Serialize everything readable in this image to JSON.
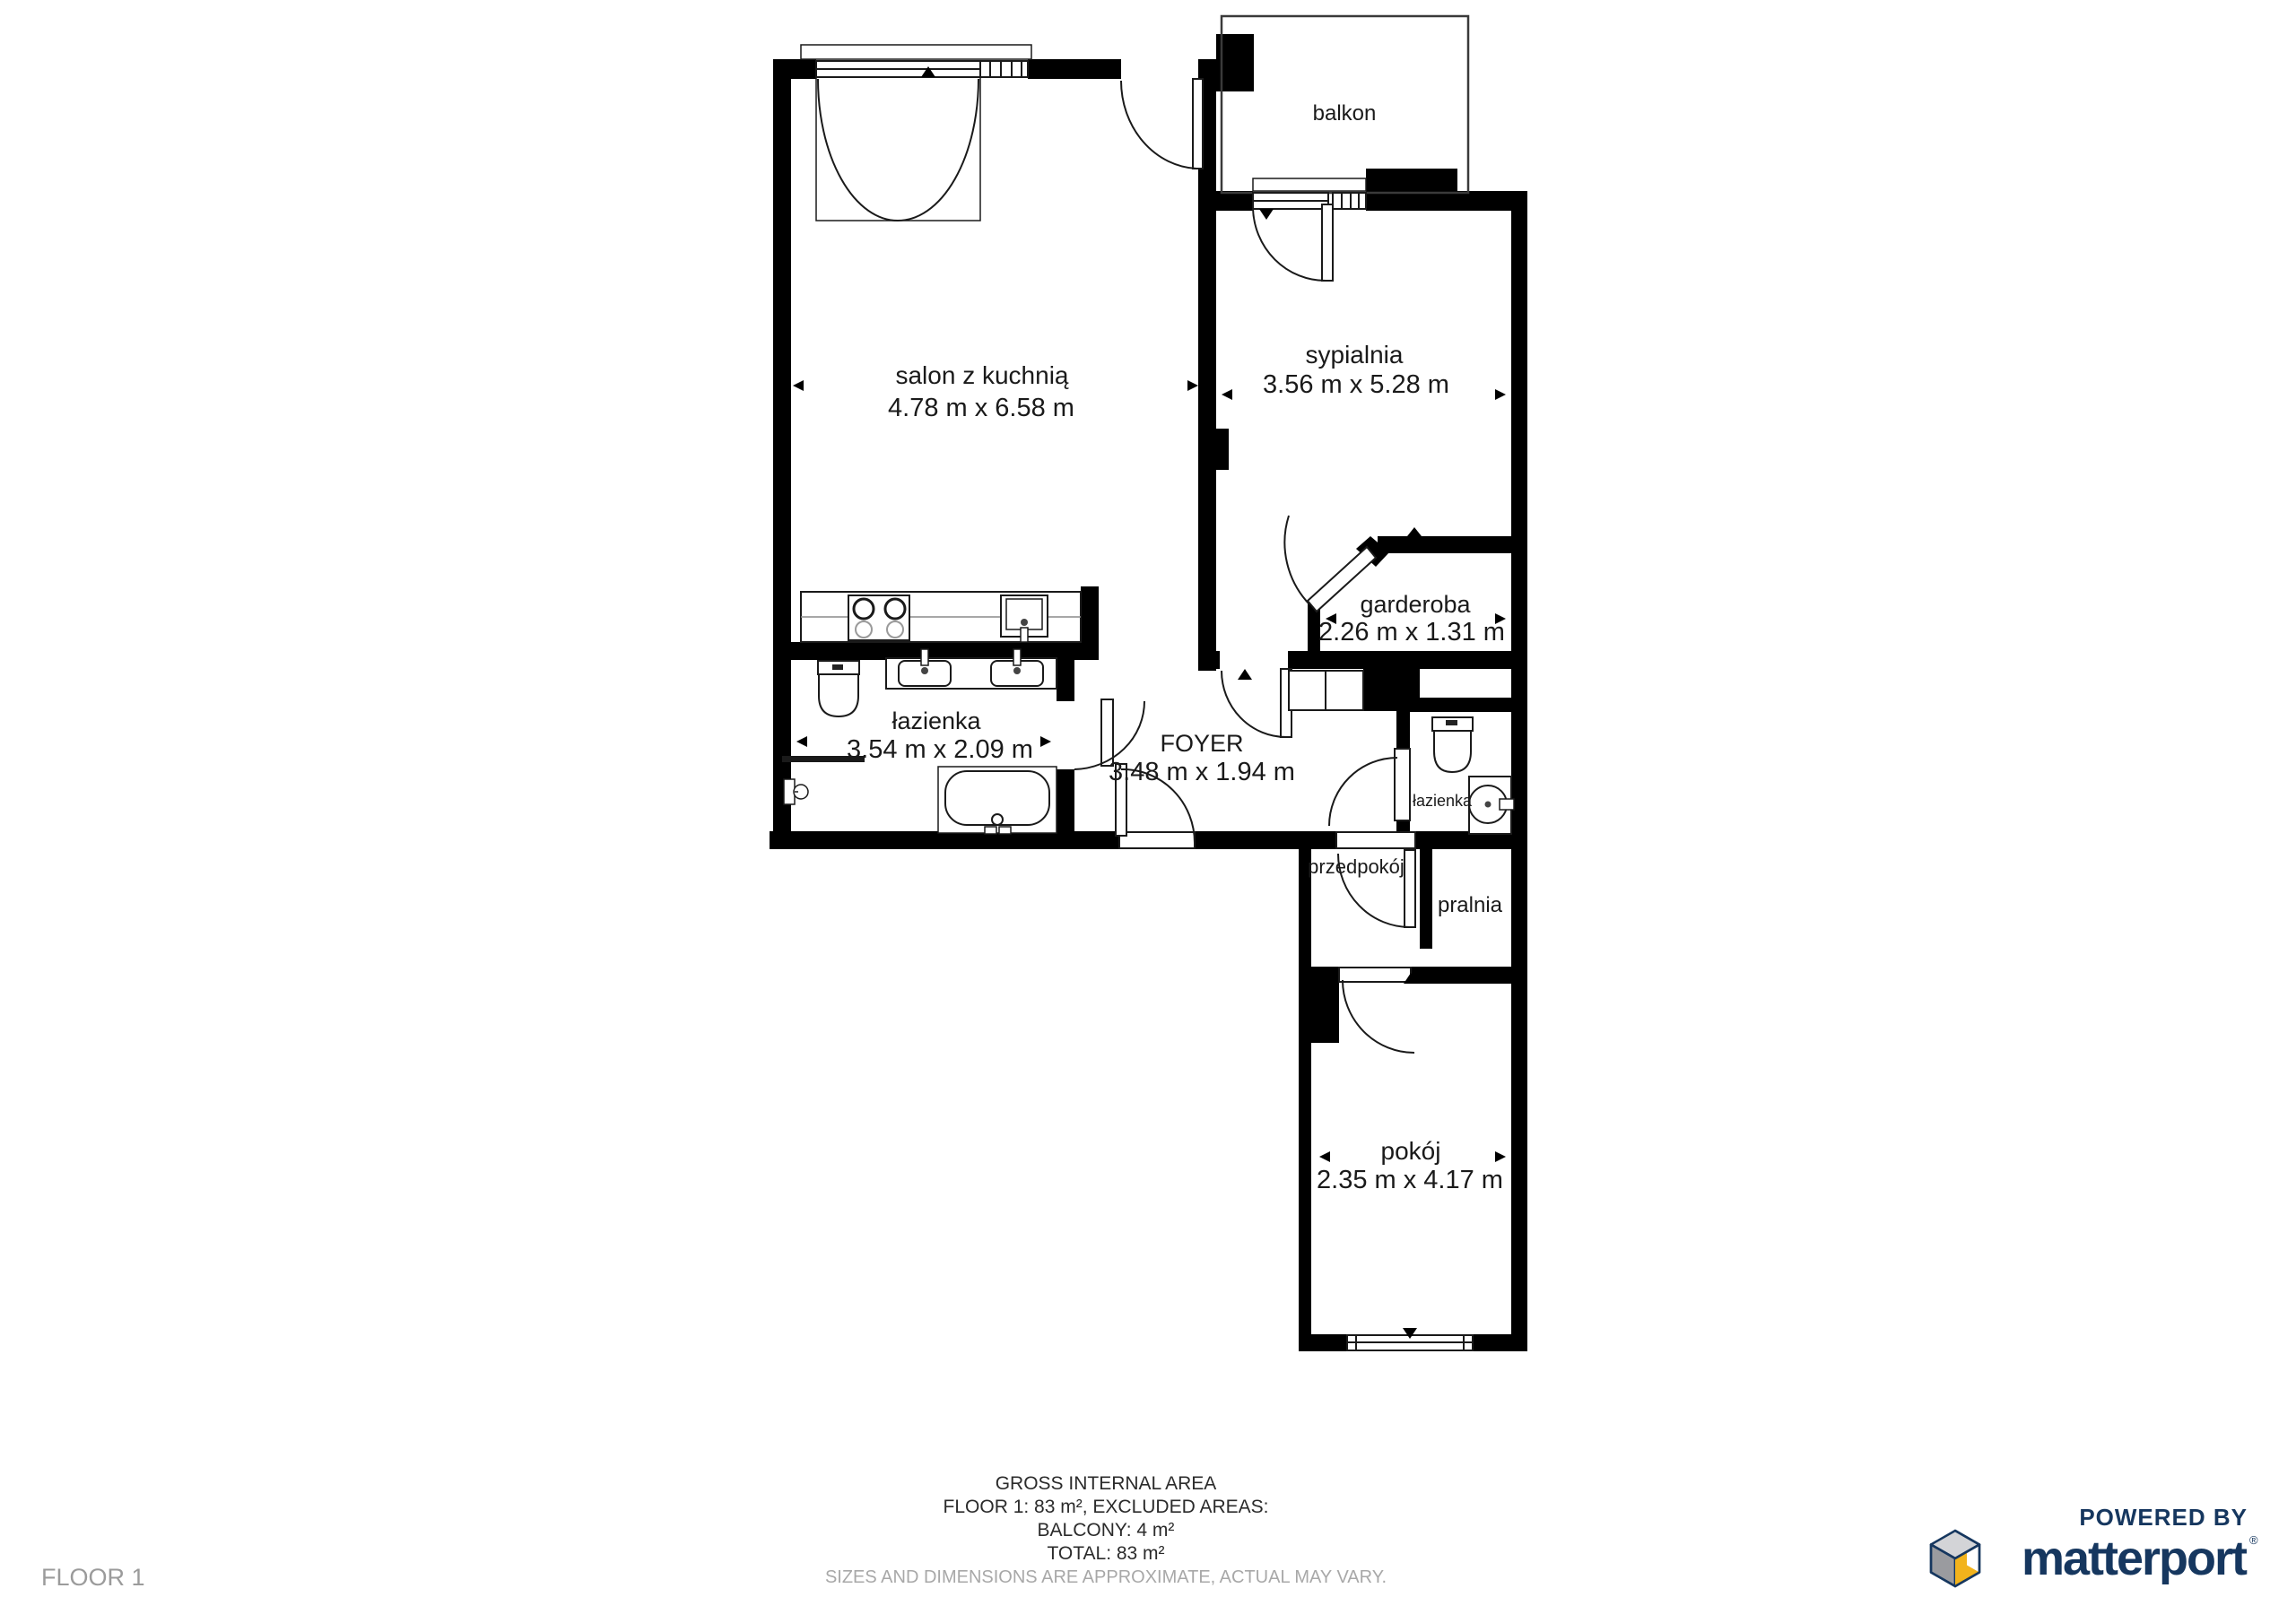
{
  "floor": {
    "label": "FLOOR 1"
  },
  "rooms": [
    {
      "id": "balkon",
      "name": "balkon",
      "dims": ""
    },
    {
      "id": "salon-z-kuchnia",
      "name": "salon z kuchnią",
      "dims": "4.78 m x 6.58 m"
    },
    {
      "id": "sypialnia",
      "name": "sypialnia",
      "dims": "3.56 m x 5.28 m"
    },
    {
      "id": "garderoba",
      "name": "garderoba",
      "dims": "2.26 m x 1.31 m"
    },
    {
      "id": "lazienka",
      "name": "łazienka",
      "dims": "3.54 m x 2.09 m"
    },
    {
      "id": "foyer",
      "name": "FOYER",
      "dims": "3.48 m x 1.94 m"
    },
    {
      "id": "lazienka-mala",
      "name": "łazienka",
      "dims": ""
    },
    {
      "id": "przedpokoj",
      "name": "przedpokój",
      "dims": ""
    },
    {
      "id": "pralnia",
      "name": "pralnia",
      "dims": ""
    },
    {
      "id": "pokoj",
      "name": "pokój",
      "dims": "2.35 m x 4.17 m"
    }
  ],
  "summary": {
    "line1": "GROSS INTERNAL AREA",
    "line2": "FLOOR 1: 83 m², EXCLUDED AREAS:",
    "line3": "BALCONY: 4 m²",
    "line4": "TOTAL: 83 m²",
    "disclaimer": "SIZES AND DIMENSIONS ARE APPROXIMATE, ACTUAL MAY VARY."
  },
  "branding": {
    "powered_by": "POWERED BY",
    "brand": "matterport",
    "registered": "®"
  },
  "colors": {
    "wall": "#000000",
    "line": "#1a1a1a",
    "brand_navy": "#16375f",
    "cube_yellow": "#f2b31c",
    "cube_gray": "#9a9b9f",
    "cube_light": "#d3d4d7",
    "muted_text": "#a8a8a8",
    "floor_tag_text": "#9b9b9b"
  }
}
